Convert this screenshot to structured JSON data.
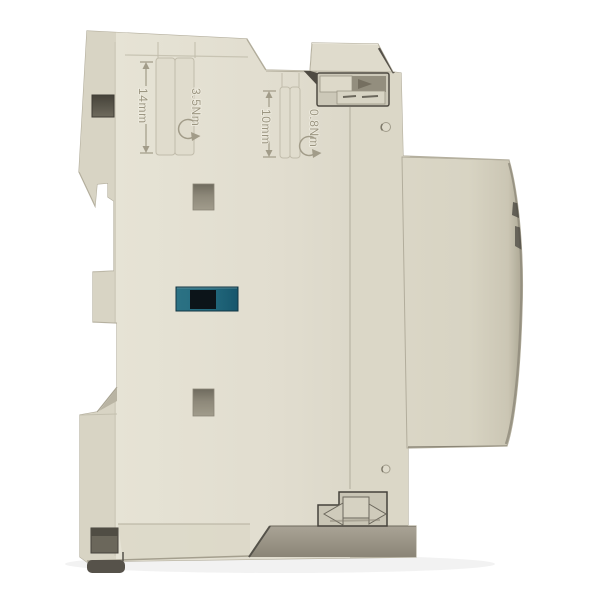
{
  "image": {
    "type": "product-photograph",
    "subject": "Side view of a beige modular DIN-rail contactor on a white background",
    "background_color": "#ffffff"
  },
  "device": {
    "body_color": "#e2dfd0",
    "side_panel_color": "#d8d4c4",
    "back_panel_color": "#dbd7c7",
    "base_shadow_color": "#958f80",
    "outline_color": "#b4af9e",
    "foot_color": "#56524a",
    "hole_dark_color": "#57544b",
    "indicator_window": {
      "teal_color": "#24697c",
      "dark_color": "#0c1419"
    },
    "markings": {
      "dim_left": "14mm",
      "torque_left": "3.5Nm",
      "dim_right": "10mm",
      "torque_right": "0.8Nm"
    }
  }
}
